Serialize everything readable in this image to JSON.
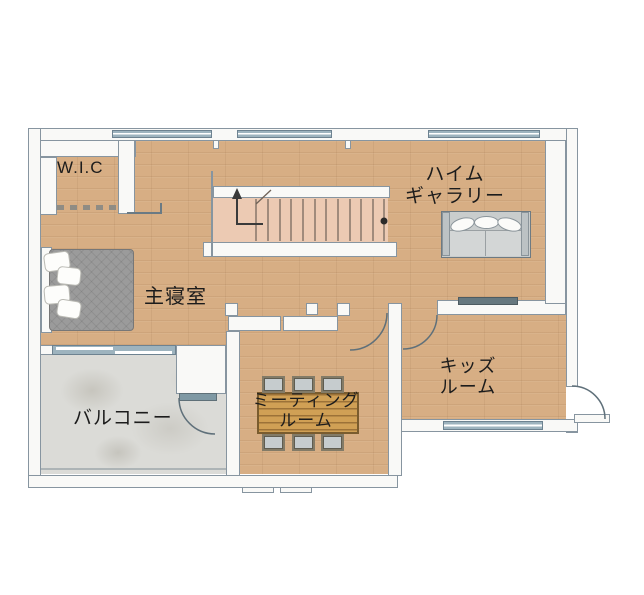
{
  "plan": {
    "rooms": {
      "wic": {
        "label": "W.I.C"
      },
      "heim_gallery": {
        "label_line1": "ハイム",
        "label_line2": "ギャラリー"
      },
      "master_bedroom": {
        "label": "主寝室"
      },
      "meeting_room": {
        "label_line1": "ミーティング",
        "label_line2": "ルーム"
      },
      "kids_room": {
        "label_line1": "キッズ",
        "label_line2": "ルーム"
      },
      "balcony": {
        "label": "バルコニー"
      }
    },
    "colors": {
      "wood_floor": "#d7ae84",
      "balcony_floor": "#dbdbd7",
      "stair_fill": "#eccab3",
      "wall_fill": "#f9f9f7",
      "wall_outline": "#8795a0",
      "window_glass": "#9db3be",
      "door_glass": "#7f99a4",
      "label_text": "#1c1c1c",
      "furniture_gray": "#9b9b9b",
      "table_wood": "#d0a055"
    }
  }
}
